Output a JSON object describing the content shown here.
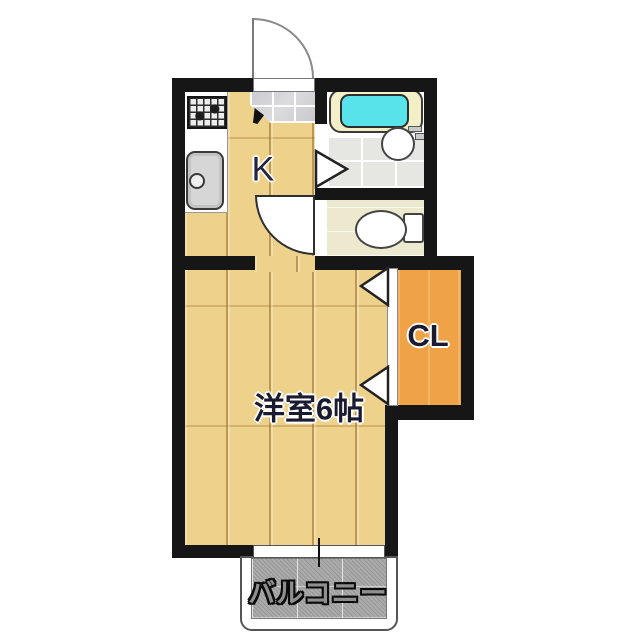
{
  "plan": {
    "title": "1K apartment floor plan",
    "labels": {
      "kitchen": "K",
      "western_room": "洋室6帖",
      "closet": "CL",
      "balcony": "バルコニー"
    },
    "colors": {
      "wall": "#161616",
      "wood_floor": "#eed28b",
      "closet": "#f0a346",
      "bathtub_water": "#58e2ea",
      "bathtub_rim": "#f3efc6",
      "toilet_floor": "#ece9cf",
      "bath_tile": "#e6e6e2",
      "entry_tile": "#d2d2d6",
      "balcony_floor": "#ababab"
    },
    "fixtures": [
      "entrance-door",
      "gas-stove",
      "kitchen-sink",
      "bathtub",
      "washbasin",
      "toilet",
      "bathroom-door",
      "toilet-door",
      "closet-folding-door",
      "window",
      "balcony"
    ]
  }
}
